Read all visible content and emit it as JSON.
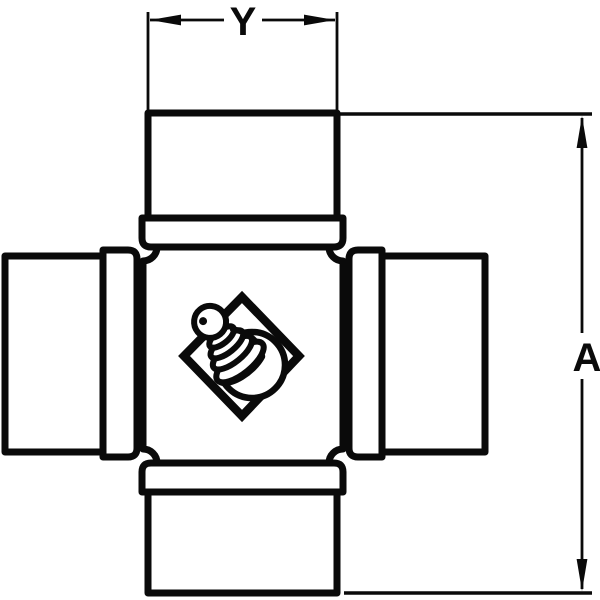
{
  "diagram": {
    "type": "technical line drawing",
    "subject": "universal joint cross with bearing cups and grease zerk",
    "labels": {
      "width_dimension": "Y",
      "height_dimension": "A"
    },
    "colors": {
      "line": "#0a0a0a",
      "background": "#ffffff"
    }
  }
}
